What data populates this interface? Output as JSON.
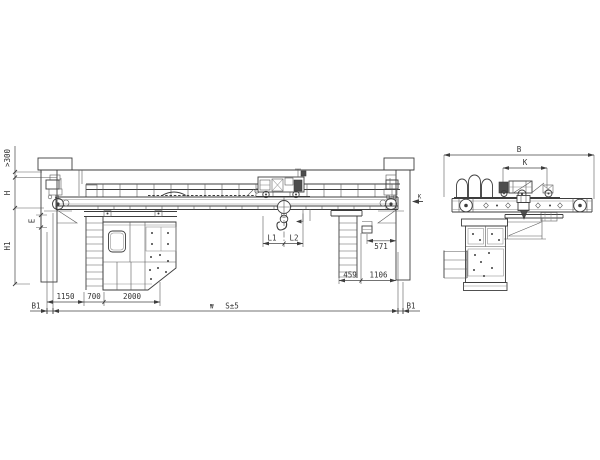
{
  "colors": {
    "line": "#3d3d3d",
    "background": "#ffffff"
  },
  "elevation": {
    "dims": {
      "clearance_top": ">300",
      "height_h": "H",
      "height_e": "E",
      "height_h1": "H1",
      "hook_left": "L1",
      "hook_right": "L2",
      "d571": "571",
      "d459": "459",
      "d1106": "1106",
      "d1150": "1150",
      "d700": "700",
      "d2000": "2000",
      "span": "S±5",
      "span_mark": "₩",
      "b1_left": "B1",
      "b1_right": "B1",
      "view_arrow_label": "K"
    }
  },
  "side": {
    "dims": {
      "overall_width": "B",
      "wheel_gauge": "K"
    }
  }
}
